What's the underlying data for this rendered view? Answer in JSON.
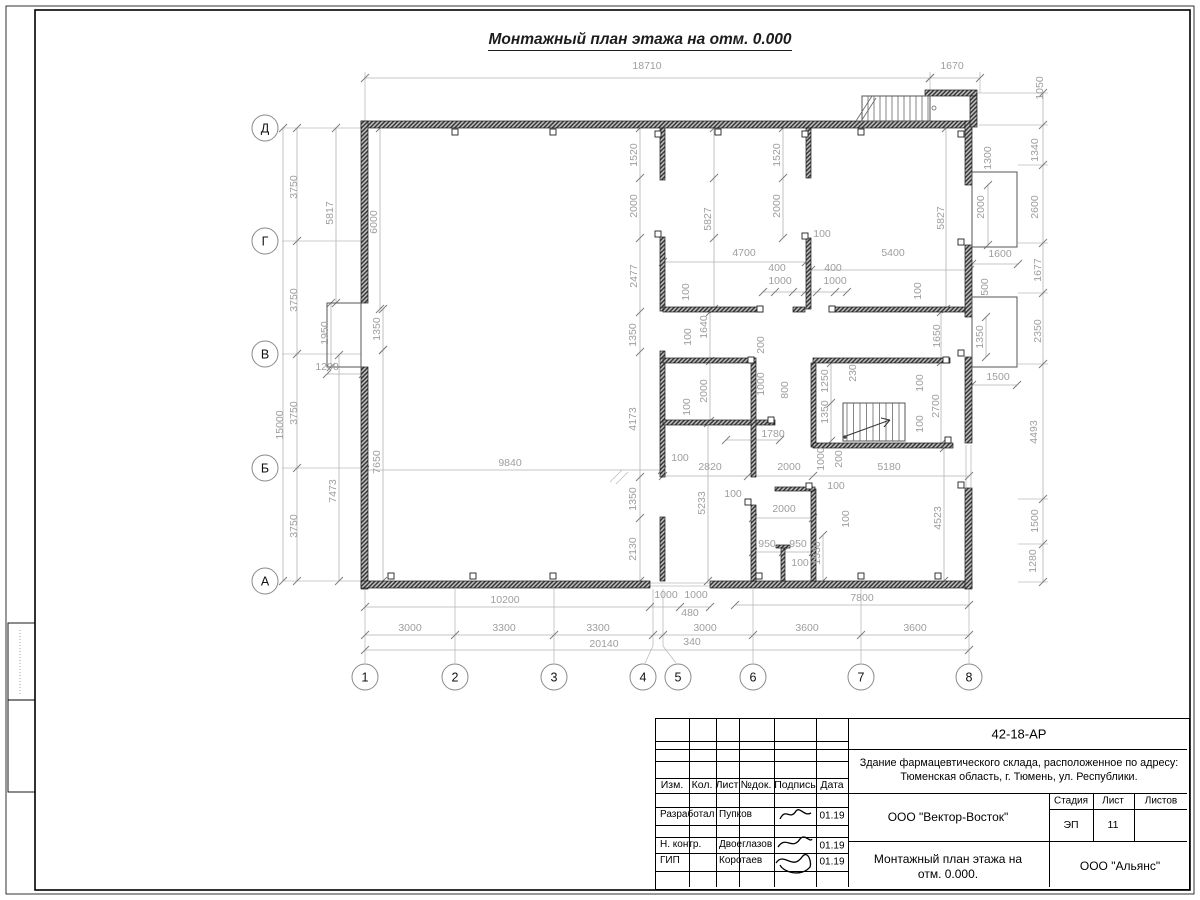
{
  "sheet": {
    "title": "Монтажный план этажа на отм. 0.000"
  },
  "axes": {
    "bottom": [
      {
        "label": "1",
        "x": 365
      },
      {
        "label": "2",
        "x": 455
      },
      {
        "label": "3",
        "x": 554
      },
      {
        "label": "4",
        "x": 643
      },
      {
        "label": "5",
        "x": 678
      },
      {
        "label": "6",
        "x": 753
      },
      {
        "label": "7",
        "x": 861
      },
      {
        "label": "8",
        "x": 969
      }
    ],
    "left": [
      {
        "label": "Д",
        "y": 128
      },
      {
        "label": "Г",
        "y": 241
      },
      {
        "label": "В",
        "y": 354
      },
      {
        "label": "Б",
        "y": 468
      },
      {
        "label": "А",
        "y": 581
      }
    ]
  },
  "dimensions": [
    {
      "t": "18710",
      "x": 647,
      "y": 69
    },
    {
      "t": "1670",
      "x": 952,
      "y": 69
    },
    {
      "t": "1050",
      "x": 1043,
      "y": 88,
      "v": 1
    },
    {
      "t": "1300",
      "x": 991,
      "y": 158,
      "v": 1
    },
    {
      "t": "1340",
      "x": 1038,
      "y": 150,
      "v": 1
    },
    {
      "t": "2600",
      "x": 1038,
      "y": 207,
      "v": 1
    },
    {
      "t": "1677",
      "x": 1041,
      "y": 270,
      "v": 1
    },
    {
      "t": "2350",
      "x": 1041,
      "y": 331,
      "v": 1
    },
    {
      "t": "4493",
      "x": 1037,
      "y": 432,
      "v": 1
    },
    {
      "t": "1500",
      "x": 1038,
      "y": 521,
      "v": 1
    },
    {
      "t": "1280",
      "x": 1036,
      "y": 561,
      "v": 1
    },
    {
      "t": "2000",
      "x": 984,
      "y": 207,
      "v": 1
    },
    {
      "t": "5827",
      "x": 944,
      "y": 218,
      "v": 1
    },
    {
      "t": "1600",
      "x": 1000,
      "y": 257
    },
    {
      "t": "500",
      "x": 988,
      "y": 287,
      "v": 1
    },
    {
      "t": "1350",
      "x": 983,
      "y": 337,
      "v": 1
    },
    {
      "t": "1500",
      "x": 998,
      "y": 380
    },
    {
      "t": "1650",
      "x": 940,
      "y": 336,
      "v": 1
    },
    {
      "t": "2700",
      "x": 939,
      "y": 406,
      "v": 1
    },
    {
      "t": "100",
      "x": 921,
      "y": 291,
      "v": 1
    },
    {
      "t": "100",
      "x": 923,
      "y": 383,
      "v": 1
    },
    {
      "t": "100",
      "x": 923,
      "y": 424,
      "v": 1
    },
    {
      "t": "4523",
      "x": 941,
      "y": 518,
      "v": 1
    },
    {
      "t": "3750",
      "x": 297,
      "y": 187,
      "v": 1
    },
    {
      "t": "3750",
      "x": 297,
      "y": 300,
      "v": 1
    },
    {
      "t": "3750",
      "x": 297,
      "y": 413,
      "v": 1
    },
    {
      "t": "3750",
      "x": 297,
      "y": 526,
      "v": 1
    },
    {
      "t": "15000",
      "x": 283,
      "y": 425,
      "v": 1
    },
    {
      "t": "5817",
      "x": 333,
      "y": 213,
      "v": 1
    },
    {
      "t": "6000",
      "x": 377,
      "y": 222,
      "v": 1
    },
    {
      "t": "1950",
      "x": 328,
      "y": 333,
      "v": 1
    },
    {
      "t": "1350",
      "x": 380,
      "y": 329,
      "v": 1
    },
    {
      "t": "1200",
      "x": 327,
      "y": 370
    },
    {
      "t": "7650",
      "x": 380,
      "y": 462,
      "v": 1
    },
    {
      "t": "7473",
      "x": 336,
      "y": 491,
      "v": 1
    },
    {
      "t": "1520",
      "x": 637,
      "y": 155,
      "v": 1
    },
    {
      "t": "2000",
      "x": 637,
      "y": 206,
      "v": 1
    },
    {
      "t": "2477",
      "x": 637,
      "y": 276,
      "v": 1
    },
    {
      "t": "1350",
      "x": 636,
      "y": 335,
      "v": 1
    },
    {
      "t": "4173",
      "x": 636,
      "y": 419,
      "v": 1
    },
    {
      "t": "1350",
      "x": 636,
      "y": 499,
      "v": 1
    },
    {
      "t": "2130",
      "x": 636,
      "y": 549,
      "v": 1
    },
    {
      "t": "5827",
      "x": 711,
      "y": 219,
      "v": 1
    },
    {
      "t": "1520",
      "x": 780,
      "y": 155,
      "v": 1
    },
    {
      "t": "2000",
      "x": 780,
      "y": 206,
      "v": 1
    },
    {
      "t": "100",
      "x": 822,
      "y": 237
    },
    {
      "t": "4700",
      "x": 744,
      "y": 256
    },
    {
      "t": "400",
      "x": 777,
      "y": 271
    },
    {
      "t": "400",
      "x": 833,
      "y": 271
    },
    {
      "t": "1000",
      "x": 780,
      "y": 284
    },
    {
      "t": "1000",
      "x": 835,
      "y": 284
    },
    {
      "t": "5400",
      "x": 893,
      "y": 256
    },
    {
      "t": "100",
      "x": 689,
      "y": 292,
      "v": 1
    },
    {
      "t": "1640",
      "x": 707,
      "y": 327,
      "v": 1
    },
    {
      "t": "100",
      "x": 691,
      "y": 337,
      "v": 1
    },
    {
      "t": "200",
      "x": 764,
      "y": 345,
      "v": 1
    },
    {
      "t": "1000",
      "x": 764,
      "y": 384,
      "v": 1
    },
    {
      "t": "800",
      "x": 788,
      "y": 390,
      "v": 1
    },
    {
      "t": "2000",
      "x": 707,
      "y": 391,
      "v": 1
    },
    {
      "t": "100",
      "x": 690,
      "y": 407,
      "v": 1
    },
    {
      "t": "1780",
      "x": 773,
      "y": 437
    },
    {
      "t": "1250",
      "x": 828,
      "y": 381,
      "v": 1
    },
    {
      "t": "1350",
      "x": 828,
      "y": 412,
      "v": 1
    },
    {
      "t": "230",
      "x": 856,
      "y": 373,
      "v": 1
    },
    {
      "t": "2820",
      "x": 710,
      "y": 470
    },
    {
      "t": "100",
      "x": 680,
      "y": 461
    },
    {
      "t": "2000",
      "x": 789,
      "y": 470
    },
    {
      "t": "5180",
      "x": 889,
      "y": 470
    },
    {
      "t": "1000",
      "x": 824,
      "y": 459,
      "v": 1
    },
    {
      "t": "200",
      "x": 842,
      "y": 459,
      "v": 1
    },
    {
      "t": "100",
      "x": 836,
      "y": 489
    },
    {
      "t": "100",
      "x": 733,
      "y": 497
    },
    {
      "t": "5233",
      "x": 705,
      "y": 503,
      "v": 1
    },
    {
      "t": "2000",
      "x": 784,
      "y": 512
    },
    {
      "t": "100",
      "x": 849,
      "y": 519,
      "v": 1
    },
    {
      "t": "950",
      "x": 767,
      "y": 547
    },
    {
      "t": "950",
      "x": 798,
      "y": 547
    },
    {
      "t": "100",
      "x": 800,
      "y": 566
    },
    {
      "t": "1530",
      "x": 820,
      "y": 553,
      "v": 1
    },
    {
      "t": "1000",
      "x": 666,
      "y": 598
    },
    {
      "t": "1000",
      "x": 696,
      "y": 598
    },
    {
      "t": "480",
      "x": 690,
      "y": 616
    },
    {
      "t": "10200",
      "x": 505,
      "y": 603
    },
    {
      "t": "7800",
      "x": 862,
      "y": 601
    },
    {
      "t": "9840",
      "x": 510,
      "y": 466
    },
    {
      "t": "3000",
      "x": 410,
      "y": 631
    },
    {
      "t": "3300",
      "x": 504,
      "y": 631
    },
    {
      "t": "3300",
      "x": 598,
      "y": 631
    },
    {
      "t": "3000",
      "x": 705,
      "y": 631
    },
    {
      "t": "3600",
      "x": 807,
      "y": 631
    },
    {
      "t": "3600",
      "x": 915,
      "y": 631
    },
    {
      "t": "20140",
      "x": 604,
      "y": 647
    },
    {
      "t": "340",
      "x": 692,
      "y": 645
    }
  ],
  "titleblock": {
    "doc_number": "42-18-АР",
    "project_line1": "Здание фармацевтического склада, расположенное по адресу:",
    "project_line2": "Тюменская область, г. Тюмень, ул. Республики.",
    "org_contractor": "ООО \"Вектор-Восток\"",
    "org_customer": "ООО \"Альянс\"",
    "drawing_title_line1": "Монтажный план этажа на",
    "drawing_title_line2": "отм. 0.000.",
    "stage_label": "Стадия",
    "sheet_label": "Лист",
    "sheets_label": "Листов",
    "stage_value": "ЭП",
    "sheet_value": "11",
    "sheets_value": "",
    "header_cols": [
      "Изм.",
      "Кол.",
      "Лист",
      "№док.",
      "Подпись",
      "Дата"
    ],
    "rows": [
      {
        "role": "Разработал",
        "name": "Пупков",
        "date": "01.19"
      },
      {
        "role": "Н. контр.",
        "name": "Двоеглазов",
        "date": "01.19"
      },
      {
        "role": "ГИП",
        "name": "Коротаев",
        "date": "01.19"
      }
    ]
  }
}
